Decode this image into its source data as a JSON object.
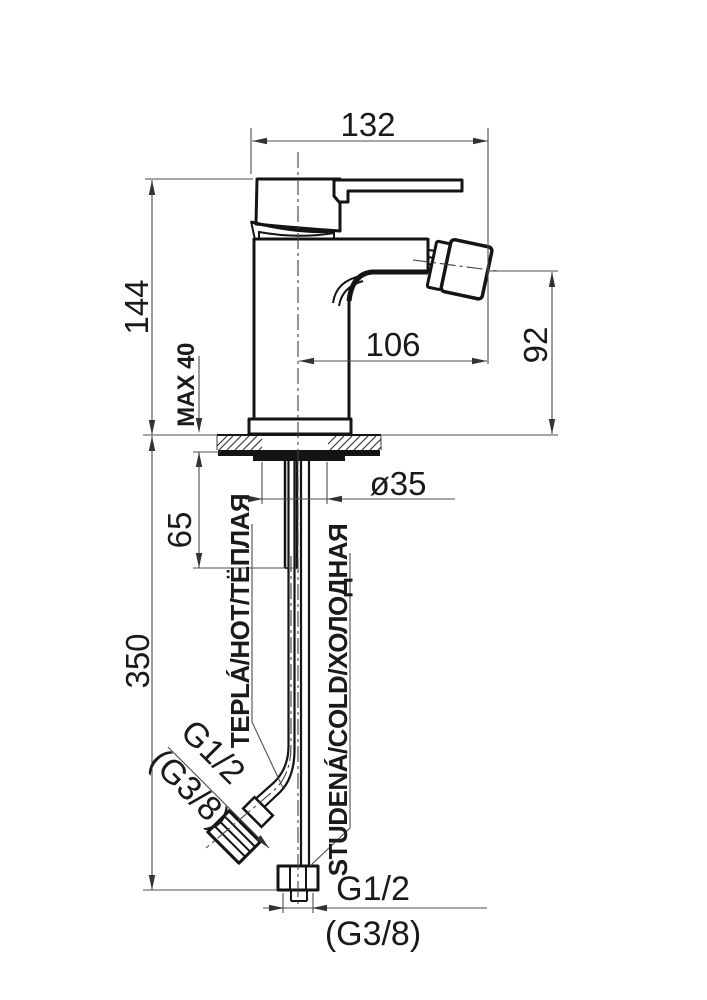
{
  "drawing": {
    "subject": "bidet-mixer-tap-dimension-drawing"
  },
  "dimensions": {
    "top_width": "132",
    "body_height": "144",
    "deck_max_thickness": "MAX 40",
    "spout_reach": "106",
    "spout_height": "92",
    "shank_length": "65",
    "hole_diameter": "ø35",
    "supply_length": "350",
    "bottom_thread": "G1/2",
    "bottom_thread_alt": "(G3/8)",
    "angled_thread": "G1/2",
    "angled_thread_alt": "(G3/8)"
  },
  "labels": {
    "hot": "TEPLÁ/HOT/ТЁПЛАЯ",
    "cold": "STUDENÁ/COLD/ХОЛОДНАЯ"
  },
  "colors": {
    "line": "#141414",
    "dimension_line": "#4d4d4d",
    "background": "#ffffff"
  }
}
